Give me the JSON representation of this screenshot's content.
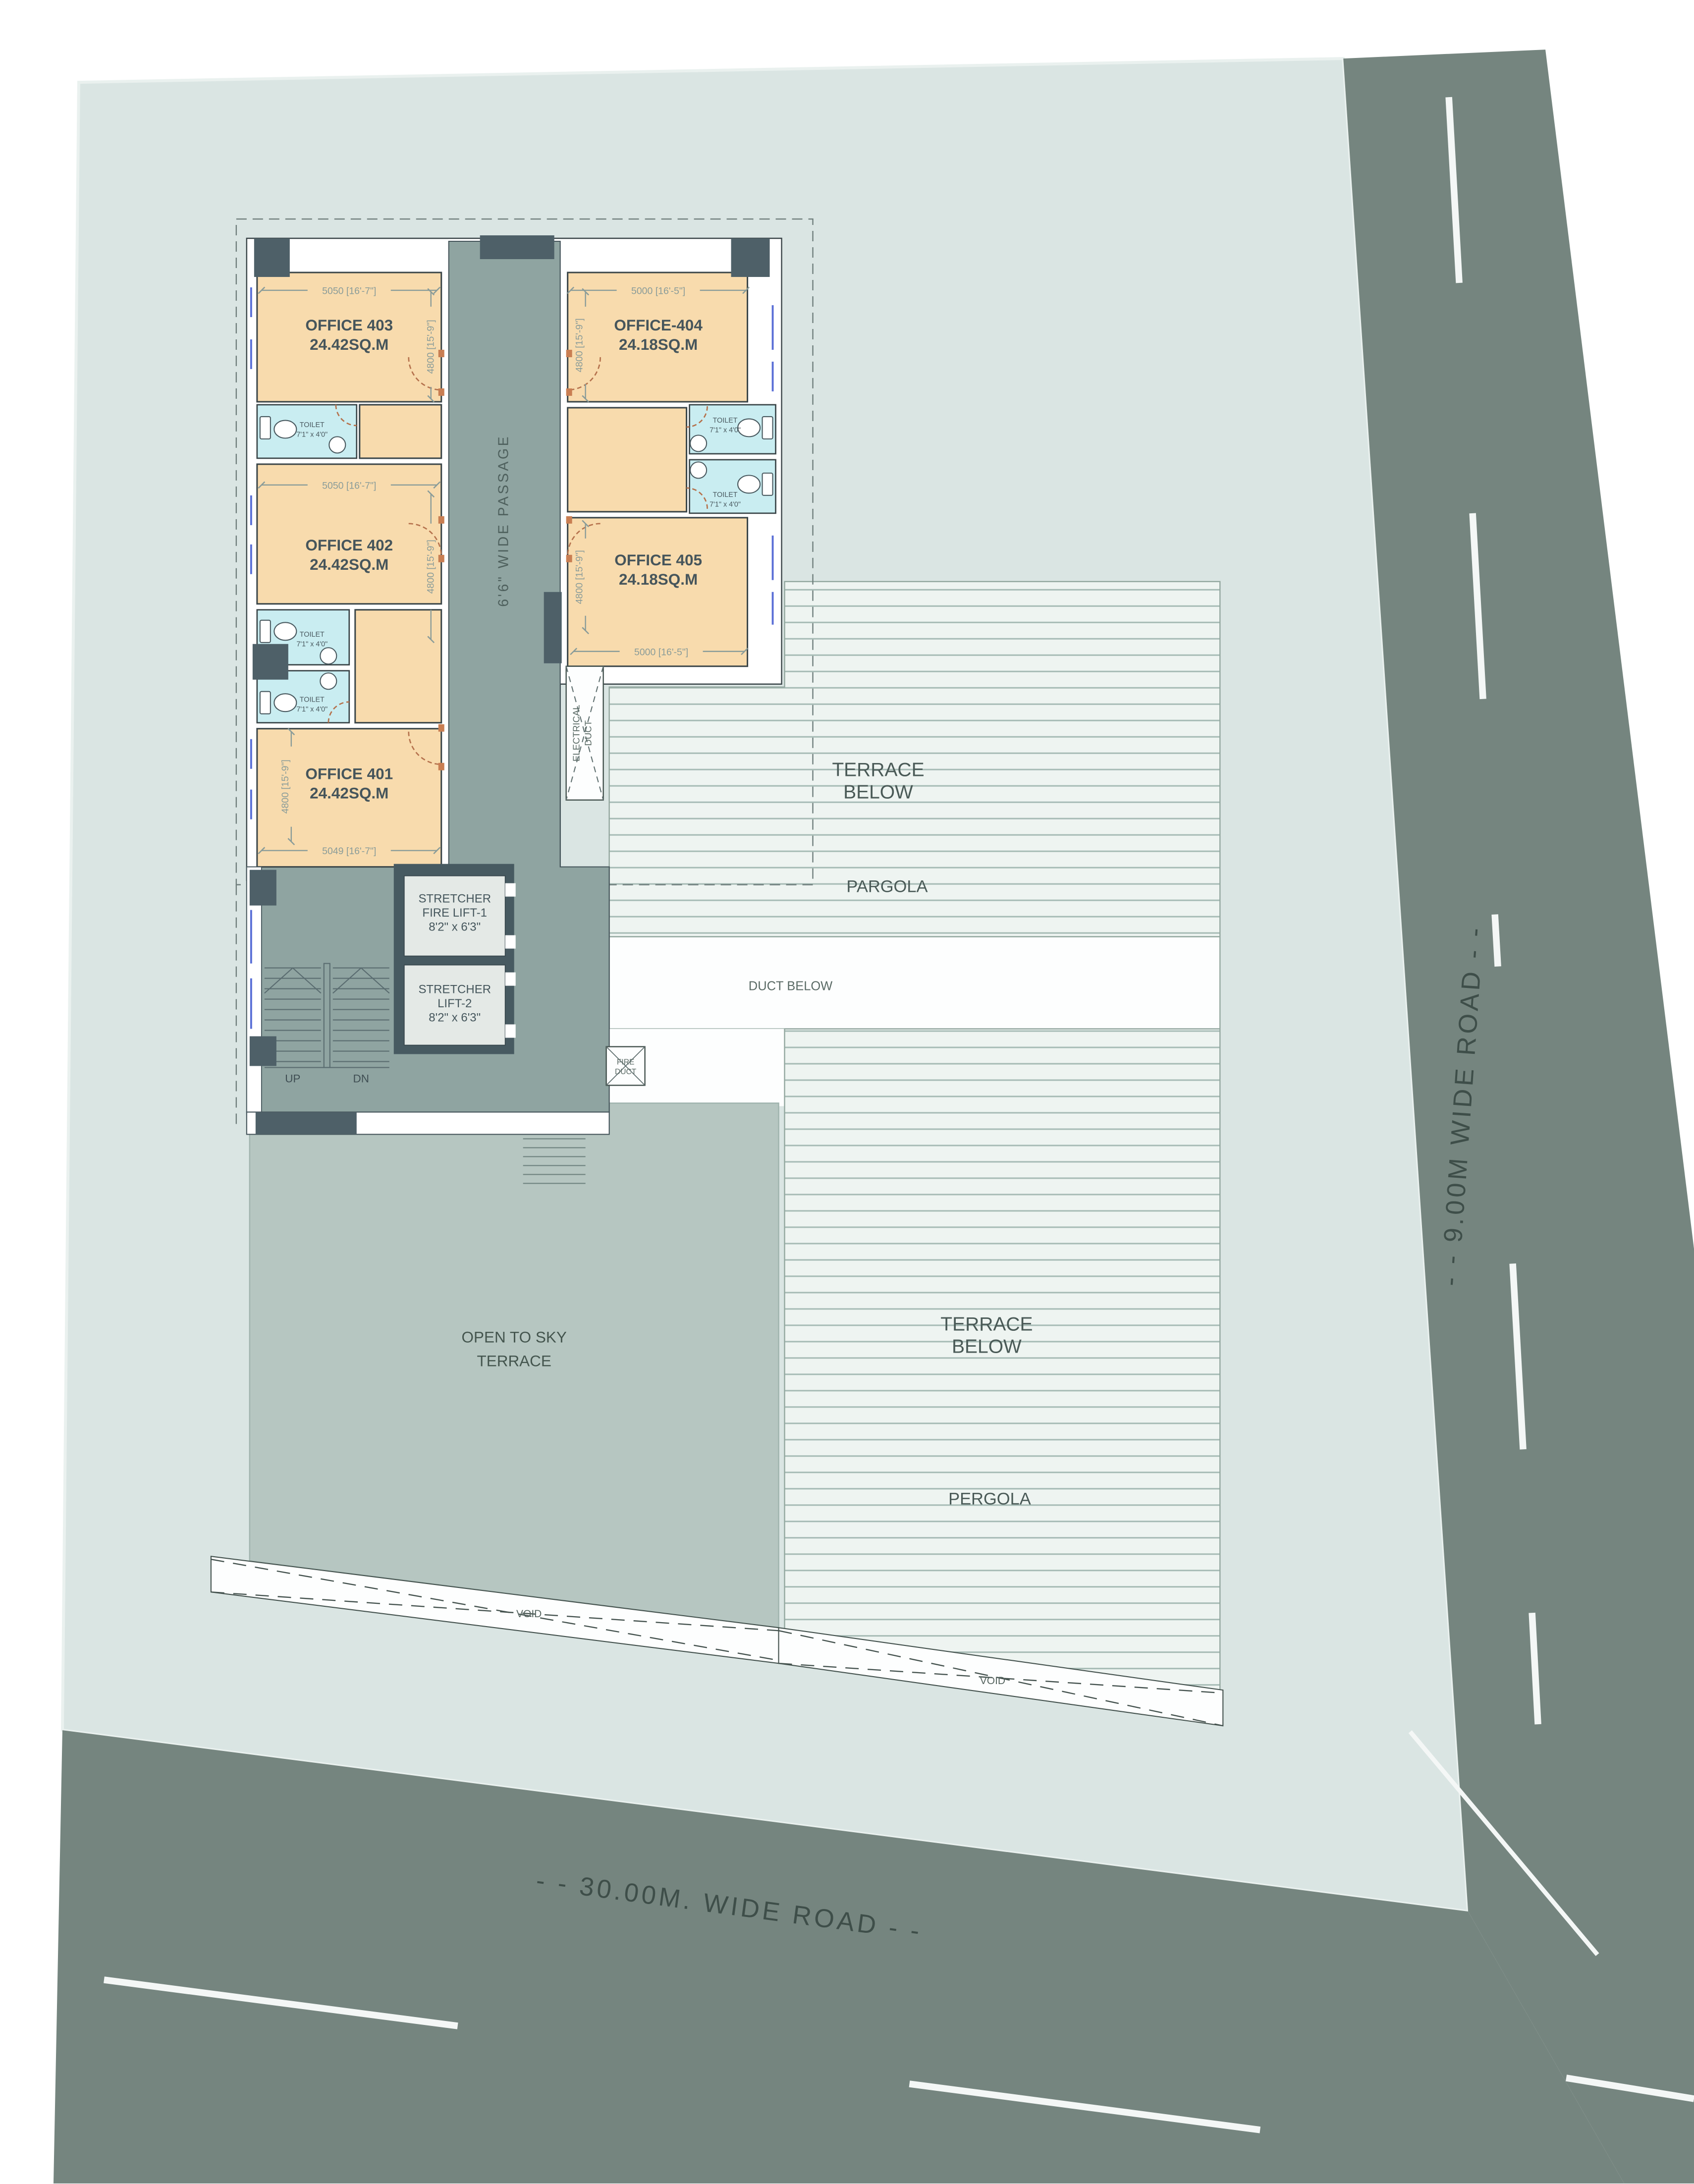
{
  "plan": {
    "offices": [
      {
        "name": "OFFICE 403",
        "area": "24.42SQ.M",
        "dim_w": "5050 [16'-7\"]",
        "dim_h": "4800 [15'-9\"]"
      },
      {
        "name": "OFFICE-404",
        "area": "24.18SQ.M",
        "dim_w": "5000 [16'-5\"]",
        "dim_h": "4800 [15'-9\"]"
      },
      {
        "name": "OFFICE 402",
        "area": "24.42SQ.M",
        "dim_w": "5050 [16'-7\"]",
        "dim_h": "4800 [15'-9\"]"
      },
      {
        "name": "OFFICE 405",
        "area": "24.18SQ.M",
        "dim_w": "5000 [16'-5\"]",
        "dim_h": "4800 [15'-9\"]"
      },
      {
        "name": "OFFICE 401",
        "area": "24.42SQ.M",
        "dim_w": "5049 [16'-7\"]",
        "dim_h": "4800 [15'-9\"]"
      }
    ],
    "toilet": {
      "label": "TOILET",
      "size": "7'1\" x 4'0\""
    },
    "passage": {
      "label": "6'6\" WIDE PASSAGE"
    },
    "lifts": [
      {
        "l1": "STRETCHER",
        "l2": "FIRE LIFT-1",
        "size": "8'2\" x 6'3\""
      },
      {
        "l1": "STRETCHER",
        "l2": "LIFT-2",
        "size": "8'2\" x 6'3\""
      }
    ],
    "stairs": {
      "up": "UP",
      "dn": "DN"
    },
    "ducts": {
      "electrical1": "ELECTRICAL",
      "electrical2": "DUCT",
      "fire1": "FIRE",
      "fire2": "DUCT",
      "below": "DUCT BELOW"
    },
    "terrace_upper": {
      "l1": "TERRACE",
      "l2": "BELOW",
      "pergola": "PARGOLA"
    },
    "terrace_lower": {
      "l1": "TERRACE",
      "l2": "BELOW",
      "pergola": "PERGOLA"
    },
    "open_terrace": {
      "l1": "OPEN TO SKY",
      "l2": "TERRACE"
    },
    "void_label": "VOID",
    "roads": {
      "bottom": "- - 30.00M. WIDE  ROAD - -",
      "right": "- - 9.00M WIDE ROAD - -"
    },
    "colors": {
      "office_fill": "#F8DBAD",
      "toilet_fill": "#C9EDF1",
      "passage_fill": "#8FA4A1",
      "open_terrace_fill": "#B6C6C1",
      "terrace_bg": "#EEF4F1",
      "terrace_line": "#A6BBB5",
      "plot_fill": "#DAE5E3",
      "road_fill": "#75857F",
      "wall_dark": "#4E6068",
      "lift_wall": "#475A61",
      "lift_floor": "#E4E9E6",
      "road_text": "#3E4E49"
    }
  }
}
